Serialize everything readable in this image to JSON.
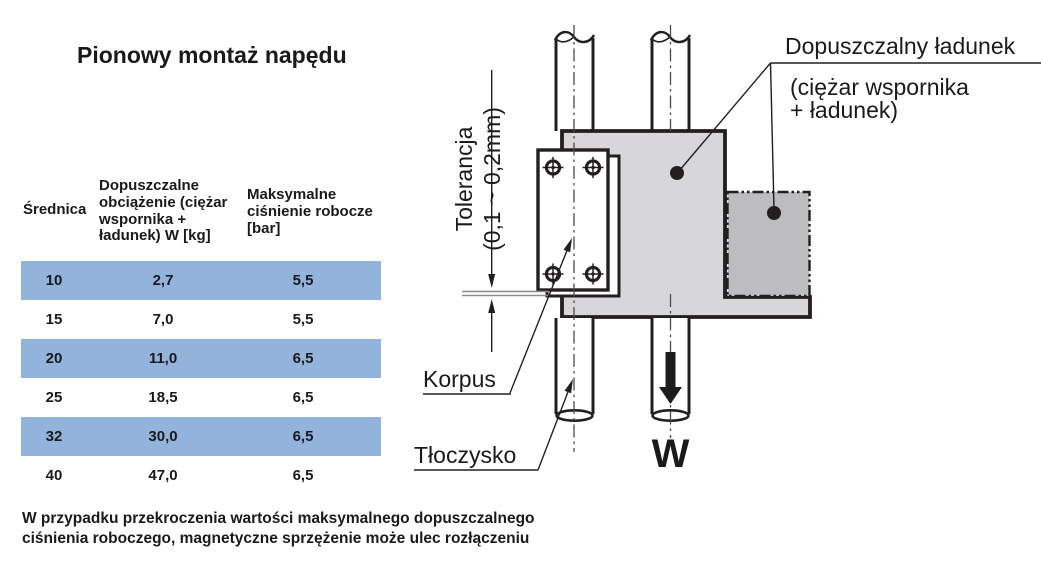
{
  "title": "Pionowy montaż napędu",
  "table": {
    "headers": [
      "Średnica",
      "Dopuszczalne obciążenie (ciężar wspornika + ładunek) W [kg]",
      "Maksymalne ciśnienie robocze [bar]"
    ],
    "rows": [
      {
        "srednica": "10",
        "obciazenie": "2,7",
        "cisnienie": "5,5"
      },
      {
        "srednica": "15",
        "obciazenie": "7,0",
        "cisnienie": "5,5"
      },
      {
        "srednica": "20",
        "obciazenie": "11,0",
        "cisnienie": "6,5"
      },
      {
        "srednica": "25",
        "obciazenie": "18,5",
        "cisnienie": "6,5"
      },
      {
        "srednica": "32",
        "obciazenie": "30,0",
        "cisnienie": "6,5"
      },
      {
        "srednica": "40",
        "obciazenie": "47,0",
        "cisnienie": "6,5"
      }
    ],
    "highlight_color": "#92b3dc"
  },
  "diagram": {
    "labels": {
      "load": "Dopuszczalny ładunek",
      "load_sub1": "(ciężar wspornika",
      "load_sub2": "+ ładunek)",
      "tolerance_line1": "Tolerancja",
      "tolerance_line2": "(0,1 ~ 0,2mm)",
      "body": "Korpus",
      "piston_rod": "Tłoczysko",
      "weight": "W"
    },
    "colors": {
      "block_light": "#d7d7d9",
      "block_dark": "#bdbdc0",
      "line": "#231f20"
    }
  },
  "footer": {
    "line1": "W przypadku przekroczenia wartości maksymalnego dopuszczalnego",
    "line2": "ciśnienia roboczego, magnetyczne sprzężenie może ulec rozłączeniu"
  }
}
